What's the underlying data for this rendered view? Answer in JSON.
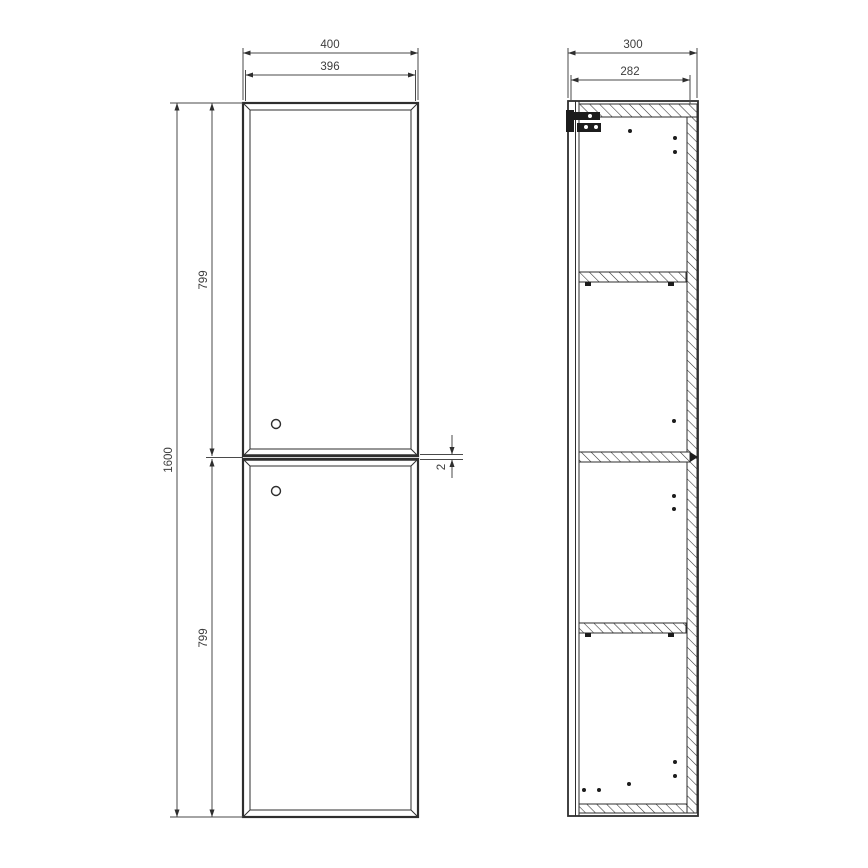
{
  "drawing": {
    "type": "technical-drawing",
    "subject": "tall two-door bathroom cabinet, front elevation and side section",
    "units": "mm",
    "colors": {
      "line": "#2e2e2e",
      "dimension_line": "#4a4a4a",
      "text": "#3d3d3d",
      "background": "#ffffff"
    },
    "front_view": {
      "width_outer": "400",
      "width_inner": "396",
      "height_total": "1600",
      "door_top_height": "799",
      "door_bottom_height": "799",
      "door_gap": "2"
    },
    "side_view": {
      "depth_outer": "300",
      "depth_inner": "282"
    }
  }
}
